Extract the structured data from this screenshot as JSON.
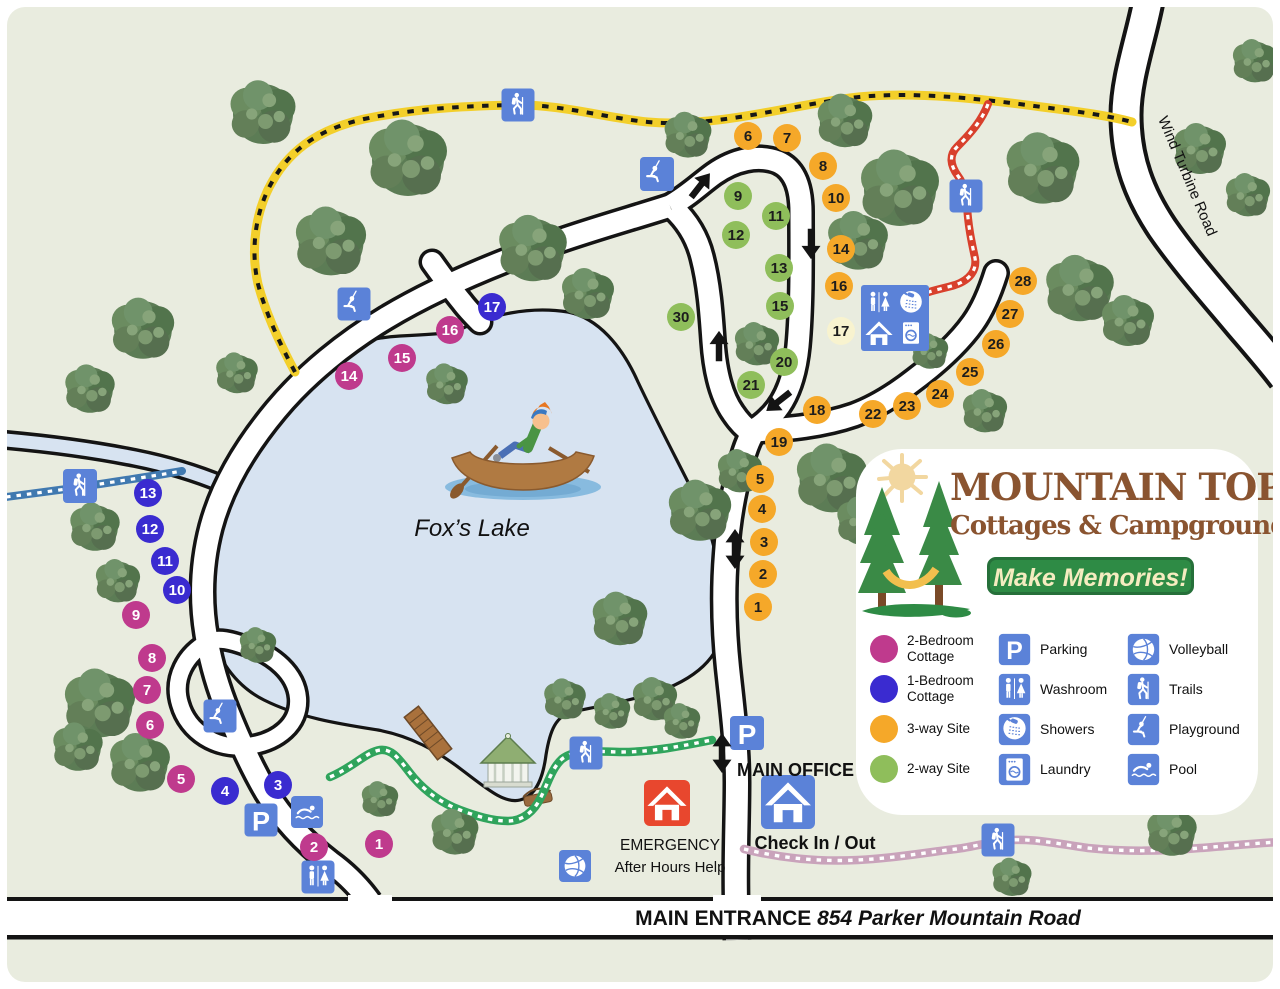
{
  "logo": {
    "title": "MOUNTAIN TOP",
    "subtitle": "Cottages & Campground",
    "tagline": "Make Memories!"
  },
  "legend": {
    "site_types": [
      {
        "key": "cottage2",
        "color": "#bf3a8d",
        "lines": [
          "2-Bedroom",
          "Cottage"
        ]
      },
      {
        "key": "cottage1",
        "color": "#3a2bd0",
        "lines": [
          "1-Bedroom",
          "Cottage"
        ]
      },
      {
        "key": "site3",
        "color": "#f5a829",
        "lines": [
          "3-way Site"
        ]
      },
      {
        "key": "site2",
        "color": "#8fbe5b",
        "lines": [
          "2-way Site"
        ]
      }
    ],
    "amenities_col1": [
      {
        "icon": "parking",
        "label": "Parking"
      },
      {
        "icon": "washroom",
        "label": "Washroom"
      },
      {
        "icon": "shower",
        "label": "Showers"
      },
      {
        "icon": "laundry",
        "label": "Laundry"
      }
    ],
    "amenities_col2": [
      {
        "icon": "volleyball",
        "label": "Volleyball"
      },
      {
        "icon": "trails",
        "label": "Trails"
      },
      {
        "icon": "playground",
        "label": "Playground"
      },
      {
        "icon": "pool",
        "label": "Pool"
      }
    ]
  },
  "labels": {
    "lake": "Fox’s Lake",
    "wind_road": "Wind Turbine Road",
    "main_office": "MAIN OFFICE",
    "check_in": "Check In / Out",
    "emergency": "EMERGENCY",
    "after_hours": "After Hours Help",
    "entrance_prefix": "MAIN ENTRANCE ",
    "entrance_address": "854 Parker Mountain Road"
  },
  "colors": {
    "bg": "#e9ecdf",
    "lake": "#d7e3f1",
    "casing": "#141414",
    "road": "#ffffff",
    "site3": "#f5a829",
    "site2": "#8fbe5b",
    "cottage2": "#bf3a8d",
    "cottage1": "#3a2bd0",
    "sitePale": "#f8f3cf",
    "sign": "#5b82d8",
    "emergency": "#e8472e",
    "trailYellow": "#f3cf2a",
    "trailRed": "#d8402c",
    "trailBlue": "#4079b0",
    "trailGreen": "#2fa45c",
    "trailPink": "#c9a3bb",
    "darkText": "#1d1d1d"
  },
  "map": {
    "roads": [
      {
        "p": "M 1150 -10 C 1144 30 1126 75 1126 115 C 1126 160 1140 195 1162 228 C 1184 260 1215 295 1240 325 C 1258 346 1272 362 1284 378",
        "w": 27,
        "cw": 35
      },
      {
        "p": "M 737 940 L 736 900 C 735 858 737 820 737 782 C 737 744 732 706 728 668 C 724 630 723 592 726 554 C 728 524 733 494 740 468 C 744 452 748 440 754 431",
        "w": 22,
        "cw": 29
      },
      {
        "p": "M 670 206 C 688 196 700 184 714 174 C 734 160 758 154 778 162 C 794 169 801 186 801 212 C 801 252 802 302 798 346 C 795 377 786 402 769 418 C 761 426 756 429 751 431",
        "w": 21,
        "cw": 28
      },
      {
        "p": "M 673 208 C 687 221 697 237 702 257 C 709 284 711 312 713 341 C 715 371 721 396 733 413 C 739 422 745 428 751 432",
        "w": 21,
        "cw": 28
      },
      {
        "p": "M 670 206 C 636 217 596 228 556 242 C 496 263 436 288 386 318 C 346 342 306 374 276 410 C 246 446 222 486 211 527 C 201 565 200 602 207 640 C 212 668 219 690 228 712 C 240 742 252 768 266 792 C 282 818 304 842 330 862 C 348 875 360 888 370 902",
        "w": 21,
        "cw": 28
      },
      {
        "p": "M 432 262 C 442 276 452 290 462 302 C 468 310 474 316 480 322",
        "w": 20,
        "cw": 27,
        "cap": "round"
      },
      {
        "p": "M 754 431 C 788 429 822 426 854 415 C 876 407 896 394 914 380 C 938 362 958 344 973 323 C 983 309 990 292 996 273",
        "w": 21,
        "cw": 28,
        "cap": "round"
      },
      {
        "p": "M 208 642 C 186 654 172 678 180 704 C 188 732 216 750 248 746 C 278 742 300 724 298 698 C 296 674 274 654 246 646 C 232 641 218 637 208 642 Z",
        "w": 16,
        "cw": 23
      }
    ],
    "stream": {
      "p": "M 6 440 C 50 444 95 450 135 458 C 170 465 198 474 222 484",
      "w": 13,
      "cw": 20
    },
    "band": {
      "y_top": 897,
      "y_bot": 935,
      "line": 4,
      "text_x": 858,
      "text_y": 925,
      "mouths": [
        [
          713,
          48
        ],
        [
          348,
          44
        ]
      ]
    },
    "trails": [
      {
        "name": "yellow-trail",
        "base": "#f3cf2a",
        "bw": 9,
        "dash": "#171717",
        "dw": 4,
        "da": "6.5 8.5",
        "p": "M 295 372 C 280 344 266 314 258 284 C 250 248 256 210 272 182 C 292 146 324 128 364 119 C 412 109 462 106 514 105 C 560 104 606 118 648 122 C 714 128 788 106 850 98 C 912 90 990 100 1042 107 C 1082 112 1110 116 1132 122"
      },
      {
        "name": "red-trail",
        "base": "#d8402c",
        "bw": 8,
        "dash": "#ffffff",
        "dw": 3.2,
        "da": "4.5 6",
        "p": "M 988 104 C 982 120 972 132 957 147 C 949 155 950 165 958 176 C 964 184 966 194 967 205 C 968 226 972 244 975 258 C 977 270 970 280 955 285 C 945 288 934 290 926 293"
      },
      {
        "name": "blue-trail",
        "base": "#4079b0",
        "bw": 8,
        "dash": "#ffffff",
        "dw": 3.2,
        "da": "4.5 6",
        "p": "M 6 497 C 30 494 52 491 74 488 C 112 482 148 477 182 471"
      },
      {
        "name": "green-trail",
        "base": "#2fa45c",
        "bw": 8.5,
        "dash": "#ffffff",
        "dw": 3.4,
        "da": "4.5 6",
        "p": "M 330 777 C 352 768 366 752 380 750 C 394 748 402 764 414 778 C 428 794 444 804 460 810 C 476 816 492 821 508 821 C 522 821 534 812 541 797 C 548 783 552 768 562 759 C 576 748 600 752 622 752 C 652 752 682 746 712 740"
      },
      {
        "name": "pink-trail",
        "base": "#c9a3bb",
        "bw": 8.5,
        "dash": "#ffffff",
        "dw": 3.4,
        "da": "4.5 6",
        "p": "M 744 849 C 780 858 820 862 858 860 C 898 858 928 852 956 849 C 972 847 986 843 1000 841 C 1030 837 1058 844 1088 848 C 1126 852 1166 851 1200 848 C 1228 846 1256 843 1280 842"
      }
    ],
    "sites": [
      {
        "n": "6",
        "x": 748,
        "y": 136,
        "t": "site3"
      },
      {
        "n": "7",
        "x": 787,
        "y": 138,
        "t": "site3"
      },
      {
        "n": "8",
        "x": 823,
        "y": 166,
        "t": "site3"
      },
      {
        "n": "10",
        "x": 836,
        "y": 198,
        "t": "site3"
      },
      {
        "n": "14",
        "x": 841,
        "y": 249,
        "t": "site3"
      },
      {
        "n": "16",
        "x": 839,
        "y": 286,
        "t": "site3"
      },
      {
        "n": "17",
        "x": 841,
        "y": 331,
        "t": "sitePale"
      },
      {
        "n": "28",
        "x": 1023,
        "y": 281,
        "t": "site3"
      },
      {
        "n": "27",
        "x": 1010,
        "y": 314,
        "t": "site3"
      },
      {
        "n": "26",
        "x": 996,
        "y": 344,
        "t": "site3"
      },
      {
        "n": "25",
        "x": 970,
        "y": 372,
        "t": "site3"
      },
      {
        "n": "24",
        "x": 940,
        "y": 394,
        "t": "site3"
      },
      {
        "n": "23",
        "x": 907,
        "y": 406,
        "t": "site3"
      },
      {
        "n": "22",
        "x": 873,
        "y": 414,
        "t": "site3"
      },
      {
        "n": "18",
        "x": 817,
        "y": 410,
        "t": "site3"
      },
      {
        "n": "19",
        "x": 779,
        "y": 442,
        "t": "site3"
      },
      {
        "n": "5",
        "x": 760,
        "y": 479,
        "t": "site3"
      },
      {
        "n": "4",
        "x": 762,
        "y": 509,
        "t": "site3"
      },
      {
        "n": "3",
        "x": 764,
        "y": 542,
        "t": "site3"
      },
      {
        "n": "2",
        "x": 763,
        "y": 574,
        "t": "site3"
      },
      {
        "n": "1",
        "x": 758,
        "y": 607,
        "t": "site3"
      },
      {
        "n": "9",
        "x": 738,
        "y": 196,
        "t": "site2"
      },
      {
        "n": "11",
        "x": 776,
        "y": 216,
        "t": "site2"
      },
      {
        "n": "12",
        "x": 736,
        "y": 235,
        "t": "site2"
      },
      {
        "n": "13",
        "x": 779,
        "y": 268,
        "t": "site2"
      },
      {
        "n": "15",
        "x": 780,
        "y": 306,
        "t": "site2"
      },
      {
        "n": "30",
        "x": 681,
        "y": 317,
        "t": "site2"
      },
      {
        "n": "20",
        "x": 784,
        "y": 362,
        "t": "site2"
      },
      {
        "n": "21",
        "x": 751,
        "y": 385,
        "t": "site2"
      },
      {
        "n": "16",
        "x": 450,
        "y": 330,
        "t": "cottage2"
      },
      {
        "n": "15",
        "x": 402,
        "y": 358,
        "t": "cottage2"
      },
      {
        "n": "14",
        "x": 349,
        "y": 376,
        "t": "cottage2"
      },
      {
        "n": "9",
        "x": 136,
        "y": 615,
        "t": "cottage2"
      },
      {
        "n": "8",
        "x": 152,
        "y": 658,
        "t": "cottage2"
      },
      {
        "n": "7",
        "x": 147,
        "y": 690,
        "t": "cottage2"
      },
      {
        "n": "6",
        "x": 150,
        "y": 725,
        "t": "cottage2"
      },
      {
        "n": "5",
        "x": 181,
        "y": 779,
        "t": "cottage2"
      },
      {
        "n": "2",
        "x": 314,
        "y": 847,
        "t": "cottage2"
      },
      {
        "n": "1",
        "x": 379,
        "y": 844,
        "t": "cottage2"
      },
      {
        "n": "17",
        "x": 492,
        "y": 307,
        "t": "cottage1"
      },
      {
        "n": "13",
        "x": 148,
        "y": 493,
        "t": "cottage1"
      },
      {
        "n": "12",
        "x": 150,
        "y": 529,
        "t": "cottage1"
      },
      {
        "n": "11",
        "x": 165,
        "y": 561,
        "t": "cottage1"
      },
      {
        "n": "10",
        "x": 177,
        "y": 590,
        "t": "cottage1"
      },
      {
        "n": "4",
        "x": 225,
        "y": 791,
        "t": "cottage1"
      },
      {
        "n": "3",
        "x": 278,
        "y": 785,
        "t": "cottage1"
      }
    ],
    "signs": [
      {
        "i": "trails",
        "x": 518,
        "y": 105,
        "s": 33
      },
      {
        "i": "trails",
        "x": 966,
        "y": 196,
        "s": 33
      },
      {
        "i": "trails",
        "x": 80,
        "y": 486,
        "s": 34
      },
      {
        "i": "trails",
        "x": 586,
        "y": 753,
        "s": 33
      },
      {
        "i": "trails",
        "x": 998,
        "y": 840,
        "s": 33
      },
      {
        "i": "playground",
        "x": 657,
        "y": 174,
        "s": 34
      },
      {
        "i": "playground",
        "x": 354,
        "y": 304,
        "s": 33
      },
      {
        "i": "playground",
        "x": 220,
        "y": 716,
        "s": 33
      },
      {
        "i": "parking",
        "x": 261,
        "y": 820,
        "s": 33
      },
      {
        "i": "parking",
        "x": 747,
        "y": 733,
        "s": 34
      },
      {
        "i": "pool",
        "x": 307,
        "y": 812,
        "s": 32
      },
      {
        "i": "washroom",
        "x": 318,
        "y": 877,
        "s": 33
      },
      {
        "i": "volleyball",
        "x": 575,
        "y": 866,
        "s": 32
      }
    ],
    "houses": [
      {
        "x": 788,
        "y": 802,
        "s": 54,
        "c": "#5b82d8",
        "name": "check-in-house-icon"
      },
      {
        "x": 667,
        "y": 803,
        "s": 46,
        "c": "#e8472e",
        "name": "emergency-house-icon"
      }
    ],
    "building": {
      "x": 861,
      "y": 285,
      "w": 68,
      "h": 66
    },
    "arrows": [
      {
        "x": 700,
        "y": 186,
        "r": 38,
        "d": 0
      },
      {
        "x": 811,
        "y": 243,
        "r": 180,
        "d": 0
      },
      {
        "x": 719,
        "y": 347,
        "r": 0,
        "d": 0
      },
      {
        "x": 779,
        "y": 401,
        "r": 232,
        "d": 0
      },
      {
        "x": 735,
        "y": 549,
        "r": 0,
        "d": 1
      },
      {
        "x": 722,
        "y": 753,
        "r": 0,
        "d": 1
      }
    ],
    "trees": [
      [
        263,
        114,
        1.25
      ],
      [
        408,
        160,
        1.5
      ],
      [
        331,
        243,
        1.35
      ],
      [
        143,
        330,
        1.2
      ],
      [
        90,
        390,
        0.95
      ],
      [
        237,
        374,
        0.8
      ],
      [
        533,
        250,
        1.3
      ],
      [
        588,
        295,
        1.0
      ],
      [
        688,
        136,
        0.9
      ],
      [
        845,
        122,
        1.05
      ],
      [
        900,
        190,
        1.5
      ],
      [
        858,
        242,
        1.15
      ],
      [
        1043,
        170,
        1.4
      ],
      [
        1200,
        150,
        1.0
      ],
      [
        1248,
        196,
        0.85
      ],
      [
        1255,
        62,
        0.85
      ],
      [
        1080,
        290,
        1.3
      ],
      [
        1128,
        322,
        1.0
      ],
      [
        985,
        412,
        0.85
      ],
      [
        447,
        385,
        0.8
      ],
      [
        95,
        528,
        0.95
      ],
      [
        118,
        582,
        0.85
      ],
      [
        100,
        705,
        1.35
      ],
      [
        140,
        764,
        1.15
      ],
      [
        78,
        748,
        0.95
      ],
      [
        258,
        646,
        0.7
      ],
      [
        620,
        620,
        1.05
      ],
      [
        655,
        700,
        0.85
      ],
      [
        700,
        512,
        1.2
      ],
      [
        740,
        472,
        0.85
      ],
      [
        832,
        480,
        1.35
      ],
      [
        862,
        522,
        0.95
      ],
      [
        757,
        345,
        0.85
      ],
      [
        930,
        352,
        0.7
      ],
      [
        565,
        700,
        0.8
      ],
      [
        612,
        712,
        0.7
      ],
      [
        682,
        722,
        0.7
      ],
      [
        380,
        800,
        0.7
      ],
      [
        455,
        833,
        0.9
      ],
      [
        1012,
        878,
        0.75
      ],
      [
        1172,
        833,
        0.95
      ]
    ],
    "text_labels": [
      {
        "key": "lake",
        "x": 472,
        "y": 536,
        "size": 24,
        "style": "italic",
        "weight": "normal",
        "anchor": "middle",
        "rot": 0,
        "name": "lake-label"
      },
      {
        "key": "wind_road",
        "x": 1183,
        "y": 178,
        "size": 15,
        "style": "normal",
        "weight": "normal",
        "anchor": "middle",
        "rot": 67,
        "name": "wind-turbine-road-label"
      },
      {
        "key": "main_office",
        "x": 737,
        "y": 776,
        "size": 18,
        "style": "normal",
        "weight": "bold",
        "anchor": "start",
        "rot": 0,
        "name": "main-office-label"
      },
      {
        "key": "check_in",
        "x": 815,
        "y": 849,
        "size": 18,
        "style": "normal",
        "weight": "bold",
        "anchor": "middle",
        "rot": 0,
        "name": "check-in-out-label"
      },
      {
        "key": "emergency",
        "x": 670,
        "y": 850,
        "size": 15.5,
        "style": "normal",
        "weight": "normal",
        "anchor": "middle",
        "rot": 0,
        "name": "emergency-label"
      },
      {
        "key": "after_hours",
        "x": 670,
        "y": 872,
        "size": 15,
        "style": "normal",
        "weight": "normal",
        "anchor": "middle",
        "rot": 0,
        "name": "after-hours-label"
      }
    ]
  }
}
